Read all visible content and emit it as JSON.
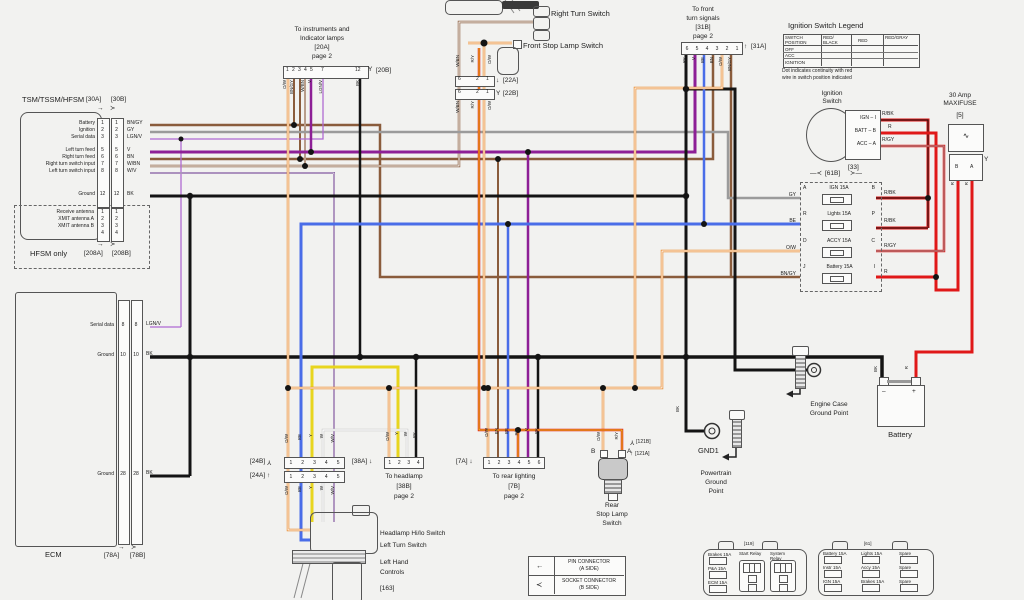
{
  "glyphs": {
    "right": "→",
    "socket_r": "≻",
    "socket_l": "≺",
    "down": "↓",
    "up": "↑",
    "left": "←",
    "fork": "Y",
    "squiggle": "∿",
    "dash_l": "—≺",
    "dash_r": "≻—"
  },
  "tsm": {
    "title": "TSM/TSSM/HFSM",
    "conn_left": "[30A]",
    "conn_right": "[30B]",
    "rows": [
      {
        "label": "Battery",
        "pin": "1",
        "wire": "BN/GY"
      },
      {
        "label": "Ignition",
        "pin": "2",
        "wire": "GY"
      },
      {
        "label": "Serial data",
        "pin": "3",
        "wire": "LGN/V"
      },
      {
        "label": "Left turn feed",
        "pin": "5",
        "wire": "V"
      },
      {
        "label": "Right turn feed",
        "pin": "6",
        "wire": "BN"
      },
      {
        "label": "Right turn switch input",
        "pin": "7",
        "wire": "W/BN"
      },
      {
        "label": "Left turn switch input",
        "pin": "8",
        "wire": "W/V"
      },
      {
        "label": "Ground",
        "pin": "12",
        "wire": "BK"
      }
    ],
    "hfsm": {
      "label": "HFSM only",
      "conn_left": "[208A]",
      "conn_right": "[208B]",
      "ant_labels": [
        "Receive antenna",
        "XMIT antenna A",
        "XMIT antenna B"
      ],
      "pins": [
        "1",
        "2",
        "3",
        "4"
      ]
    }
  },
  "ecm": {
    "title": "ECM",
    "conn_left": "[78A]",
    "conn_right": "[78B]",
    "rows": [
      {
        "label": "Serial data",
        "pin": "8",
        "wire": "LGN/V"
      },
      {
        "label": "Ground",
        "pin": "10",
        "wire": "BK"
      },
      {
        "label": "Ground",
        "pin": "28",
        "wire": "BK"
      }
    ]
  },
  "conn20": {
    "title_lines": [
      "To instruments and",
      "Indicator lamps",
      "[20A]",
      "page 2"
    ],
    "pins": [
      "1",
      "2",
      "3",
      "4",
      "5",
      "7",
      "12"
    ],
    "label_b": "[20B]",
    "wires": [
      "O/W",
      "BN/GY",
      "W/BN",
      "V",
      "LGN/V",
      "BK"
    ]
  },
  "conn22": {
    "label_a": "[22A]",
    "label_b": "[22B]",
    "pins": [
      "6",
      "2",
      "1"
    ],
    "wires": [
      "W/BN",
      "R/Y",
      "O/W"
    ]
  },
  "right_turn_switch": {
    "label": "Right Turn Switch"
  },
  "front_stop": {
    "label": "Front Stop Lamp Switch"
  },
  "conn31": {
    "title_lines": [
      "To front",
      "turn signals",
      "[31B]",
      "page 2"
    ],
    "label_a": "[31A]",
    "pins": [
      "6",
      "5",
      "4",
      "3",
      "2",
      "1"
    ],
    "wires": [
      "BK",
      "V",
      "BE",
      "BN",
      "O/W",
      "BN/GY"
    ]
  },
  "legend_table": {
    "title": "Ignition Switch Legend",
    "col_headers": [
      "SWITCH POSITION",
      "RED/ BLACK",
      "RED",
      "RED/GRAY"
    ],
    "rows": [
      "OFF",
      "ACC",
      "IGNITION"
    ],
    "note_lines": [
      "Dot indicates continuity with red",
      "wire in switch position indicated"
    ]
  },
  "ignition_switch": {
    "title_lines": [
      "Ignition",
      "Switch"
    ],
    "pins": [
      "IGN – I",
      "BATT – B",
      "ACC – A"
    ],
    "wires": [
      "R/BK",
      "R",
      "R/GY"
    ],
    "conn": "[33]"
  },
  "fuseblock": {
    "header": "[61B]",
    "rows": [
      {
        "left_pin": "A",
        "name": "IGN",
        "amp": "15A",
        "right_pin": "B",
        "left_wire": "GY",
        "right_wire": "R/BK"
      },
      {
        "left_pin": "R",
        "name": "Lights",
        "amp": "15A",
        "right_pin": "P",
        "left_wire": "BE",
        "right_wire": "R/BK"
      },
      {
        "left_pin": "D",
        "name": "ACCY",
        "amp": "15A",
        "right_pin": "C",
        "left_wire": "O/W",
        "right_wire": "R/GY"
      },
      {
        "left_pin": "J",
        "name": "Battery",
        "amp": "15A",
        "right_pin": "I",
        "left_wire": "BN/GY",
        "right_wire": "R"
      }
    ]
  },
  "maxifuse": {
    "title_lines": [
      "30 Amp",
      "MAXIFUSE"
    ],
    "conn": "[5]",
    "pins": [
      "B",
      "A"
    ],
    "wires": [
      "R",
      "R"
    ]
  },
  "battery": {
    "label": "Battery",
    "neg": "–",
    "pos": "+",
    "neg_wire": "BK",
    "pos_wire": "R"
  },
  "engine_ground": {
    "label_lines": [
      "Engine Case",
      "Ground Point"
    ]
  },
  "gnd1": {
    "label": "GND1",
    "wire": "BK",
    "point_lines": [
      "Powertrain",
      "Ground",
      "Point"
    ]
  },
  "rear_stop": {
    "pins": [
      "B",
      "A"
    ],
    "wires": [
      "O/W",
      "R/Y"
    ],
    "conn_b": "[121B]",
    "conn_a": "[121A]",
    "label_lines": [
      "Rear",
      "Stop Lamp",
      "Switch"
    ]
  },
  "conn24": {
    "label_b": "[24B]",
    "label_a": "[24A]",
    "pins": [
      "1",
      "2",
      "3",
      "4",
      "5"
    ],
    "wires": [
      "O/W",
      "BE",
      "Y",
      "W",
      "W/V"
    ]
  },
  "conn38": {
    "label": "[38A]",
    "pins": [
      "1",
      "2",
      "3",
      "4"
    ],
    "wires": [
      "O/W",
      "Y",
      "W",
      "BK"
    ],
    "title_lines": [
      "To headlamp",
      "[38B]",
      "page 2"
    ]
  },
  "conn7": {
    "label": "[7A]",
    "pins": [
      "1",
      "2",
      "3",
      "4",
      "5",
      "6"
    ],
    "wires": [
      "O/W",
      "BN",
      "BE",
      "R/Y",
      "V",
      "BK"
    ],
    "title_lines": [
      "To rear lighting",
      "[7B]",
      "page 2"
    ]
  },
  "controls": {
    "switch1": "Headlamp Hi/lo Switch",
    "switch2": "Left Turn Switch",
    "name_lines": [
      "Left Hand",
      "Controls"
    ],
    "conn": "[163]"
  },
  "key": {
    "pin_line1": "PIN CONNECTOR",
    "pin_line2": "(A SIDE)",
    "socket_line1": "SOCKET CONNECTOR",
    "socket_line2": "(B SIDE)"
  },
  "box119": {
    "label": "[119]",
    "fuses": [
      "Brakes 15A",
      "P&A 15A",
      "ECM 15A"
    ],
    "relays": [
      "Start Relay",
      "System Relay"
    ]
  },
  "box61": {
    "label": "[61]",
    "fuses": [
      "Battery 15A",
      "Lights 15A",
      "Spare",
      "Instr 15A",
      "Accy 15A",
      "Spare",
      "IGN 15A",
      "Brakes 15A",
      "Spare"
    ]
  }
}
